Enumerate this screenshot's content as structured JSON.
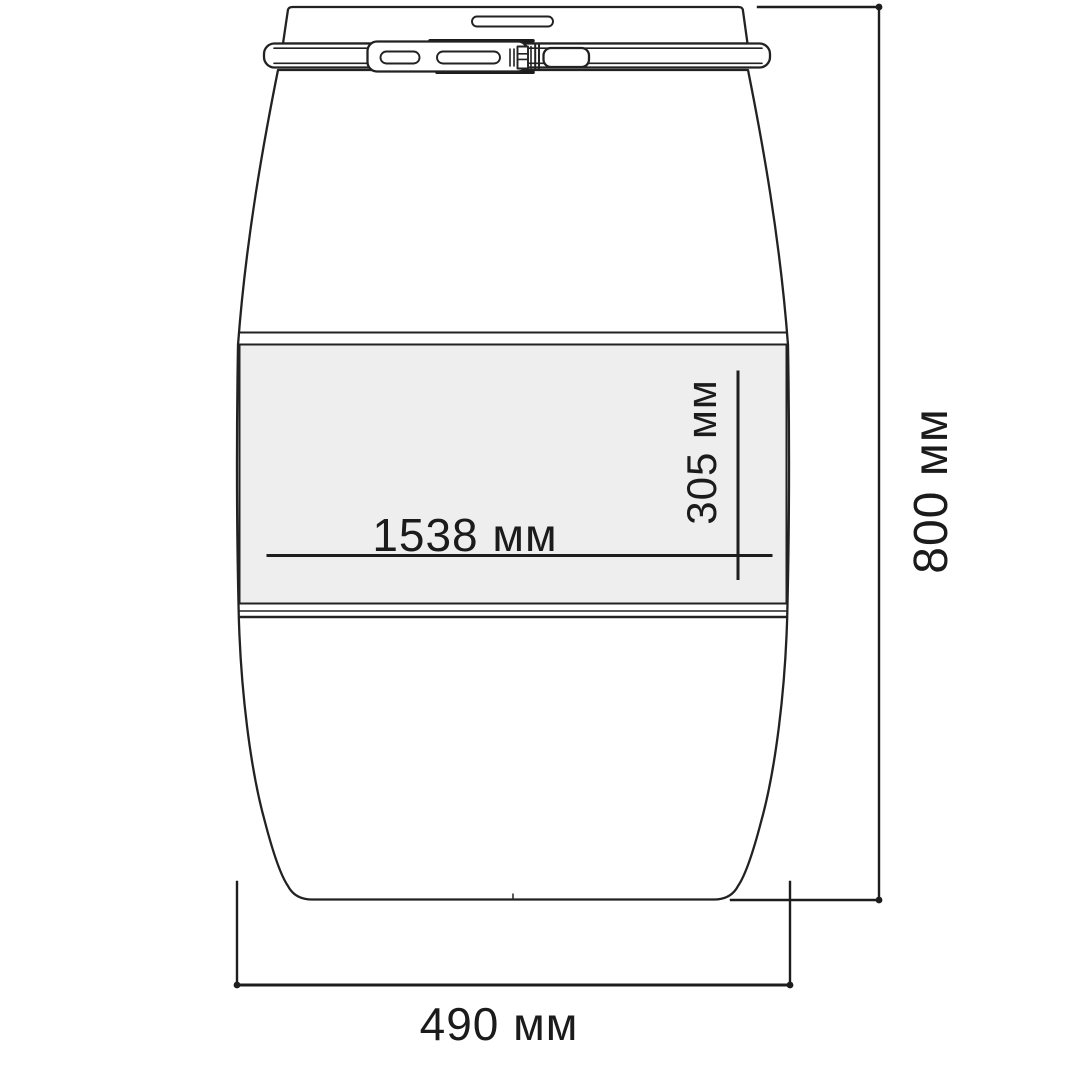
{
  "drawing": {
    "unit": "мм",
    "dimensions": {
      "length": {
        "value": "1538",
        "label": "1538 мм"
      },
      "band_height": {
        "value": "305",
        "label": "305 мм"
      },
      "height": {
        "value": "800",
        "label": "800 мм"
      },
      "width": {
        "value": "490",
        "label": "490 мм"
      }
    },
    "colors": {
      "line": "#222222",
      "dimension_line": "#1d1d1d",
      "label_band_fill": "#eeeeee",
      "background": "#ffffff"
    }
  }
}
